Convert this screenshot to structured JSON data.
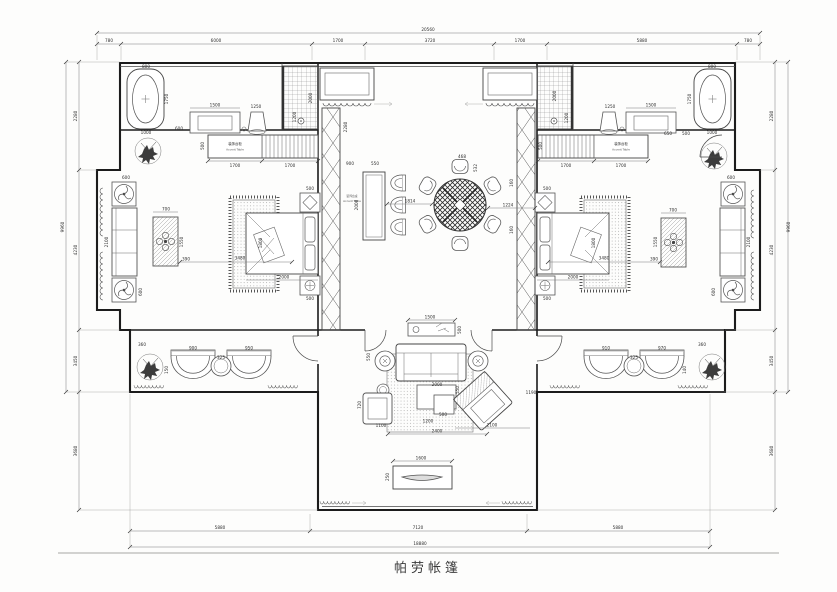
{
  "title": {
    "text": "帕劳帐篷"
  },
  "labels": {
    "cabinet_left_cn": "装饰台柜",
    "cabinet_left_en": "Accent Table",
    "cabinet_right_cn": "装饰台柜",
    "cabinet_right_en": "Accent Table",
    "console_cn": "装饰台桌",
    "console_en": "Accent Table"
  },
  "dims": {
    "t0": "20560",
    "t1": "780",
    "t2": "6000",
    "t3": "1700",
    "t4": "3720",
    "t5": "1700",
    "t6": "5880",
    "t7": "780",
    "b0": "18880",
    "b1": "5880",
    "b2": "7120",
    "b3": "5880",
    "l0": "9960",
    "l1": "2280",
    "l2": "4230",
    "l3": "3450",
    "l4": "3680",
    "r0": "9960",
    "r1": "2280",
    "r2": "4230",
    "r3": "3450",
    "r4": "3680",
    "cor": "2280",
    "bl1": "800",
    "bl2": "1750",
    "bl3": "1000",
    "bl4": "1500",
    "bl5": "600",
    "bl6": "1250",
    "bl7": "1200",
    "bl8": "2000",
    "bl9": "500",
    "bl10": "1700",
    "bl11": "1700",
    "br1": "2000",
    "br2": "1200",
    "br3": "1250",
    "br4": "1500",
    "br5": "800",
    "br6": "1750",
    "br7": "1000",
    "br8": "650",
    "br9": "500",
    "br10": "500",
    "br11": "1700",
    "br12": "1700",
    "bd1": "500",
    "bd2": "1800",
    "bd3": "2000",
    "bd4": "500",
    "bd5": "390",
    "bd6": "3480",
    "be1": "500",
    "be2": "1800",
    "be3": "2000",
    "be4": "500",
    "be5": "390",
    "be6": "3480",
    "ba1": "600",
    "ba2": "2100",
    "ba3": "600",
    "ba4": "700",
    "ba5": "1550",
    "bb1": "600",
    "bb2": "2100",
    "bb3": "600",
    "bb4": "700",
    "bb5": "1550",
    "d1": "900",
    "d2": "550",
    "d3": "2000",
    "d4": "1814",
    "d5": "468",
    "d6": "532",
    "d7": "1224",
    "d8": "160",
    "d9": "160",
    "e1": "1500",
    "e2": "500",
    "e3": "550",
    "e4": "2000",
    "e5": "550",
    "e6": "500",
    "e7": "1200",
    "e8": "720",
    "e9": "1100",
    "e10": "2400",
    "e11": "2100",
    "e12": "1190",
    "f1": "1600",
    "f2": "250",
    "g1": "360",
    "g2": "900",
    "g3": "150",
    "g4": "325",
    "g5": "950",
    "h1": "910",
    "h2": "325",
    "h3": "970",
    "h4": "360",
    "h5": "140"
  }
}
